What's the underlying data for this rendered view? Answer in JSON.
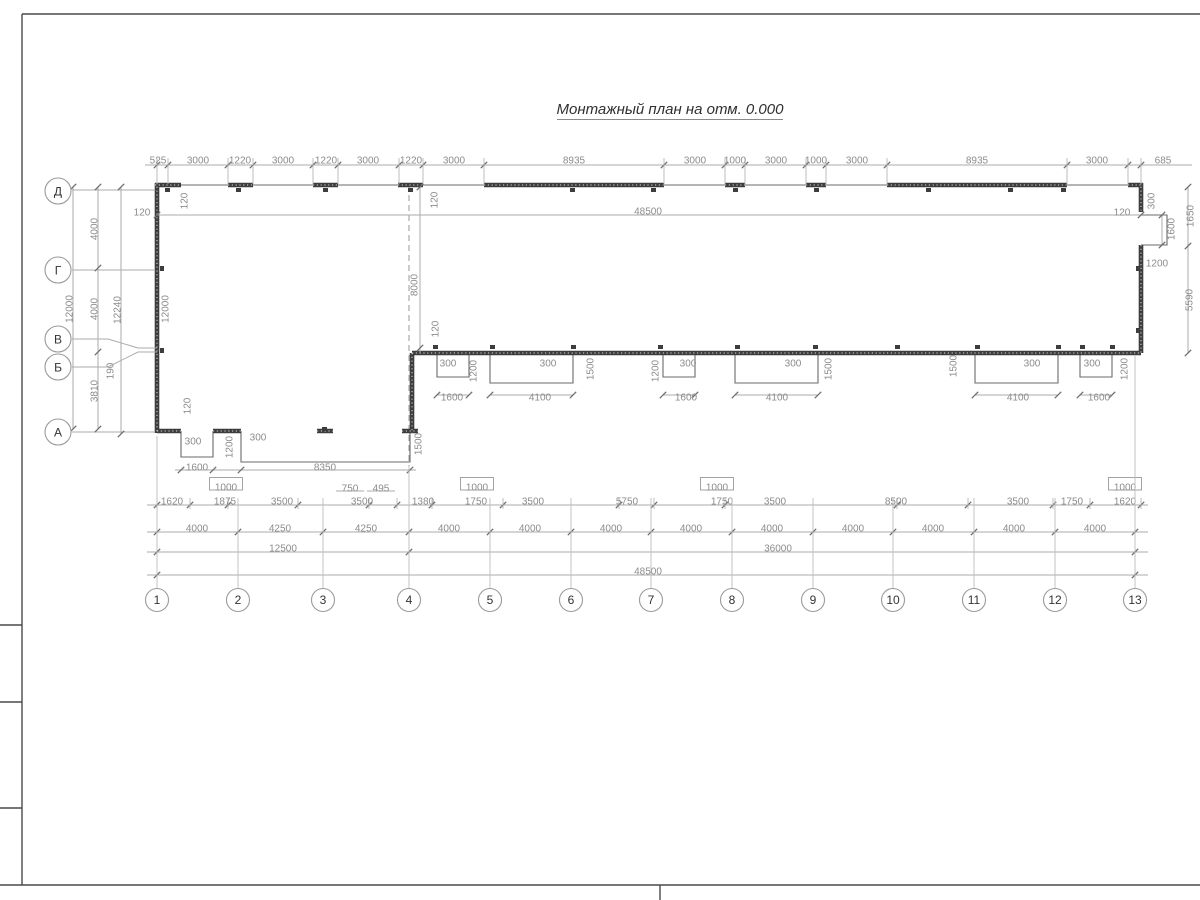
{
  "title": {
    "text": "Монтажный план на отм. 0.000"
  },
  "colors": {
    "wall": "#3d3d3d",
    "dim_line": "#ababab",
    "dim_text": "#8c8c8c",
    "axis_text": "#333333",
    "background": "#ffffff"
  },
  "axes": {
    "bottom": [
      {
        "label": "1",
        "x": 157,
        "gy": 436
      },
      {
        "label": "2",
        "x": 238,
        "gy": 498
      },
      {
        "label": "3",
        "x": 323,
        "gy": 498
      },
      {
        "label": "4",
        "x": 409,
        "gy": 466
      },
      {
        "label": "5",
        "x": 490,
        "gy": 498
      },
      {
        "label": "6",
        "x": 571,
        "gy": 498
      },
      {
        "label": "7",
        "x": 651,
        "gy": 498
      },
      {
        "label": "8",
        "x": 732,
        "gy": 498
      },
      {
        "label": "9",
        "x": 813,
        "gy": 498
      },
      {
        "label": "10",
        "x": 893,
        "gy": 498
      },
      {
        "label": "11",
        "x": 974,
        "gy": 498
      },
      {
        "label": "12",
        "x": 1055,
        "gy": 498
      },
      {
        "label": "13",
        "x": 1135,
        "gy": 356
      }
    ],
    "left": [
      {
        "label": "Д",
        "y": 191
      },
      {
        "label": "Г",
        "y": 270
      },
      {
        "label": "В",
        "y": 339
      },
      {
        "label": "Б",
        "y": 367
      },
      {
        "label": "А",
        "y": 432
      }
    ]
  },
  "dim_rows": [
    {
      "y": 165,
      "x1": 145,
      "x2": 1192,
      "ticks": [
        157,
        168,
        228,
        253,
        313,
        338,
        399,
        423,
        484,
        664,
        725,
        745,
        806,
        826,
        887,
        1067,
        1128,
        1141
      ],
      "ext": [
        158,
        184
      ]
    },
    {
      "y": 215,
      "x1": 157,
      "x2": 1141,
      "ticks": [
        157,
        1141
      ]
    },
    {
      "y": 470,
      "x1": 175,
      "x2": 416,
      "ticks": [
        181,
        213,
        241,
        410
      ]
    },
    {
      "y": 505,
      "x1": 147,
      "x2": 1148,
      "ticks": [
        157,
        190,
        228,
        298,
        369,
        397,
        432,
        503,
        619,
        654,
        725,
        897,
        968,
        1053,
        1090,
        1141
      ],
      "ext": [
        498,
        509
      ]
    },
    {
      "y": 532,
      "x1": 147,
      "x2": 1148,
      "ticks": [
        157,
        238,
        323,
        409,
        490,
        571,
        651,
        732,
        813,
        893,
        974,
        1055,
        1135
      ]
    },
    {
      "y": 552,
      "x1": 147,
      "x2": 1148,
      "ticks": [
        157,
        409,
        1135
      ]
    },
    {
      "y": 575,
      "x1": 147,
      "x2": 1148,
      "ticks": [
        157,
        1135
      ]
    },
    {
      "y": 395,
      "x1": 437,
      "x2": 469,
      "ticks": [
        437,
        469
      ]
    },
    {
      "y": 395,
      "x1": 490,
      "x2": 573,
      "ticks": [
        490,
        573
      ]
    },
    {
      "y": 395,
      "x1": 663,
      "x2": 695,
      "ticks": [
        663,
        695
      ]
    },
    {
      "y": 395,
      "x1": 735,
      "x2": 818,
      "ticks": [
        735,
        818
      ]
    },
    {
      "y": 395,
      "x1": 975,
      "x2": 1058,
      "ticks": [
        975,
        1058
      ]
    },
    {
      "y": 395,
      "x1": 1080,
      "x2": 1112,
      "ticks": [
        1080,
        1112
      ]
    }
  ],
  "dim_cols": [
    {
      "x": 73,
      "y1": 187,
      "y2": 429,
      "ticks": [
        187,
        429
      ]
    },
    {
      "x": 98,
      "y1": 187,
      "y2": 429,
      "ticks": [
        187,
        268,
        352,
        429
      ]
    },
    {
      "x": 121,
      "y1": 187,
      "y2": 434,
      "ticks": [
        187,
        434
      ]
    },
    {
      "x": 420,
      "y1": 187,
      "y2": 353,
      "ticks": [
        187,
        348
      ]
    },
    {
      "x": 1188,
      "y1": 187,
      "y2": 353,
      "ticks": [
        187,
        246,
        353
      ]
    },
    {
      "x": 1162,
      "y1": 215,
      "y2": 245,
      "ticks": [
        215,
        245
      ]
    }
  ],
  "labels": [
    {
      "t": "525",
      "x": 158,
      "y": 160
    },
    {
      "t": "3000",
      "x": 198,
      "y": 160
    },
    {
      "t": "1220",
      "x": 240,
      "y": 160
    },
    {
      "t": "3000",
      "x": 283,
      "y": 160
    },
    {
      "t": "1220",
      "x": 326,
      "y": 160
    },
    {
      "t": "3000",
      "x": 368,
      "y": 160
    },
    {
      "t": "1220",
      "x": 411,
      "y": 160
    },
    {
      "t": "3000",
      "x": 454,
      "y": 160
    },
    {
      "t": "8935",
      "x": 574,
      "y": 160
    },
    {
      "t": "3000",
      "x": 695,
      "y": 160
    },
    {
      "t": "1000",
      "x": 735,
      "y": 160
    },
    {
      "t": "3000",
      "x": 776,
      "y": 160
    },
    {
      "t": "1000",
      "x": 816,
      "y": 160
    },
    {
      "t": "3000",
      "x": 857,
      "y": 160
    },
    {
      "t": "8935",
      "x": 977,
      "y": 160
    },
    {
      "t": "3000",
      "x": 1097,
      "y": 160
    },
    {
      "t": "685",
      "x": 1163,
      "y": 160
    },
    {
      "t": "48500",
      "x": 648,
      "y": 211
    },
    {
      "t": "8000",
      "x": 414,
      "y": 285,
      "r": -90
    },
    {
      "t": "120",
      "x": 142,
      "y": 212
    },
    {
      "t": "120",
      "x": 184,
      "y": 201,
      "r": -90
    },
    {
      "t": "120",
      "x": 434,
      "y": 200,
      "r": -90
    },
    {
      "t": "120",
      "x": 435,
      "y": 329,
      "r": -90
    },
    {
      "t": "120",
      "x": 187,
      "y": 406,
      "r": -90
    },
    {
      "t": "120",
      "x": 1122,
      "y": 212
    },
    {
      "t": "12000",
      "x": 69,
      "y": 309,
      "r": -90
    },
    {
      "t": "4000",
      "x": 94,
      "y": 229,
      "r": -90
    },
    {
      "t": "4000",
      "x": 94,
      "y": 309,
      "r": -90
    },
    {
      "t": "3810",
      "x": 94,
      "y": 391,
      "r": -90
    },
    {
      "t": "190",
      "x": 110,
      "y": 371,
      "r": -90
    },
    {
      "t": "12240",
      "x": 117,
      "y": 310,
      "r": -90
    },
    {
      "t": "12000",
      "x": 165,
      "y": 309,
      "r": -90
    },
    {
      "t": "300",
      "x": 1151,
      "y": 201,
      "r": -90
    },
    {
      "t": "1600",
      "x": 1171,
      "y": 229,
      "r": -90
    },
    {
      "t": "1200",
      "x": 1157,
      "y": 263
    },
    {
      "t": "1650",
      "x": 1190,
      "y": 216,
      "r": -90
    },
    {
      "t": "5590",
      "x": 1189,
      "y": 300,
      "r": -90
    },
    {
      "t": "300",
      "x": 448,
      "y": 363
    },
    {
      "t": "1200",
      "x": 473,
      "y": 371,
      "r": -90
    },
    {
      "t": "1600",
      "x": 452,
      "y": 397
    },
    {
      "t": "300",
      "x": 548,
      "y": 363
    },
    {
      "t": "1500",
      "x": 590,
      "y": 369,
      "r": -90
    },
    {
      "t": "4100",
      "x": 540,
      "y": 397
    },
    {
      "t": "1200",
      "x": 655,
      "y": 371,
      "r": -90
    },
    {
      "t": "300",
      "x": 688,
      "y": 363
    },
    {
      "t": "1600",
      "x": 686,
      "y": 397
    },
    {
      "t": "300",
      "x": 793,
      "y": 363
    },
    {
      "t": "1500",
      "x": 828,
      "y": 369,
      "r": -90
    },
    {
      "t": "4100",
      "x": 777,
      "y": 397
    },
    {
      "t": "1500",
      "x": 953,
      "y": 366,
      "r": -90
    },
    {
      "t": "300",
      "x": 1032,
      "y": 363
    },
    {
      "t": "4100",
      "x": 1018,
      "y": 397
    },
    {
      "t": "300",
      "x": 1092,
      "y": 363
    },
    {
      "t": "1200",
      "x": 1124,
      "y": 369,
      "r": -90
    },
    {
      "t": "1600",
      "x": 1099,
      "y": 397
    },
    {
      "t": "300",
      "x": 193,
      "y": 441
    },
    {
      "t": "1200",
      "x": 229,
      "y": 447,
      "r": -90
    },
    {
      "t": "300",
      "x": 258,
      "y": 437
    },
    {
      "t": "1500",
      "x": 418,
      "y": 444,
      "r": -90
    },
    {
      "t": "1600",
      "x": 197,
      "y": 467
    },
    {
      "t": "8350",
      "x": 325,
      "y": 467
    },
    {
      "t": "1000",
      "x": 226,
      "y": 487,
      "s": "box"
    },
    {
      "t": "750",
      "x": 350,
      "y": 488,
      "s": "ul"
    },
    {
      "t": "495",
      "x": 381,
      "y": 488,
      "s": "ul"
    },
    {
      "t": "1000",
      "x": 477,
      "y": 487,
      "s": "box"
    },
    {
      "t": "1000",
      "x": 717,
      "y": 487,
      "s": "box"
    },
    {
      "t": "1000",
      "x": 1125,
      "y": 487,
      "s": "box"
    },
    {
      "t": "1620",
      "x": 172,
      "y": 501
    },
    {
      "t": "1875",
      "x": 225,
      "y": 501
    },
    {
      "t": "3500",
      "x": 282,
      "y": 501
    },
    {
      "t": "3500",
      "x": 362,
      "y": 501
    },
    {
      "t": "1380",
      "x": 423,
      "y": 501
    },
    {
      "t": "1750",
      "x": 476,
      "y": 501
    },
    {
      "t": "3500",
      "x": 533,
      "y": 501
    },
    {
      "t": "5750",
      "x": 627,
      "y": 501
    },
    {
      "t": "1750",
      "x": 722,
      "y": 501
    },
    {
      "t": "3500",
      "x": 775,
      "y": 501
    },
    {
      "t": "8500",
      "x": 896,
      "y": 501
    },
    {
      "t": "3500",
      "x": 1018,
      "y": 501
    },
    {
      "t": "1750",
      "x": 1072,
      "y": 501
    },
    {
      "t": "1620",
      "x": 1125,
      "y": 501
    },
    {
      "t": "4000",
      "x": 197,
      "y": 528
    },
    {
      "t": "4250",
      "x": 280,
      "y": 528
    },
    {
      "t": "4250",
      "x": 366,
      "y": 528
    },
    {
      "t": "4000",
      "x": 449,
      "y": 528
    },
    {
      "t": "4000",
      "x": 530,
      "y": 528
    },
    {
      "t": "4000",
      "x": 611,
      "y": 528
    },
    {
      "t": "4000",
      "x": 691,
      "y": 528
    },
    {
      "t": "4000",
      "x": 772,
      "y": 528
    },
    {
      "t": "4000",
      "x": 853,
      "y": 528
    },
    {
      "t": "4000",
      "x": 933,
      "y": 528
    },
    {
      "t": "4000",
      "x": 1014,
      "y": 528
    },
    {
      "t": "4000",
      "x": 1095,
      "y": 528
    },
    {
      "t": "12500",
      "x": 283,
      "y": 548
    },
    {
      "t": "36000",
      "x": 778,
      "y": 548
    },
    {
      "t": "48500",
      "x": 648,
      "y": 571
    }
  ]
}
